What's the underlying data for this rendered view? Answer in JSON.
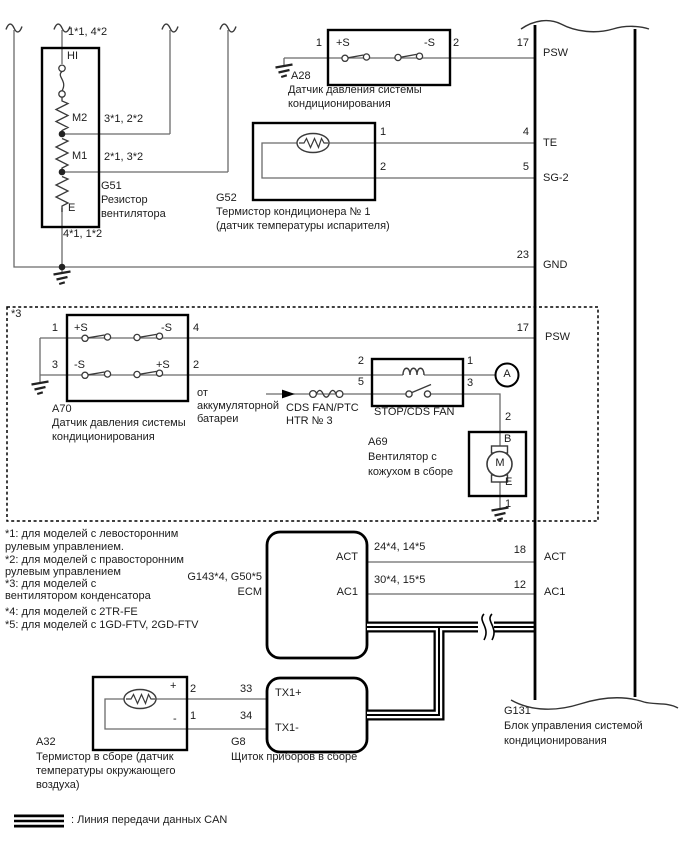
{
  "g51": {
    "w_top": "1*1, 4*2",
    "t_hi": "HI",
    "t_m2": "M2",
    "t_m1": "M1",
    "t_e": "E",
    "w_m2": "3*1, 2*2",
    "w_m1": "2*1, 3*2",
    "w_bot": "4*1, 1*2",
    "code": "G51",
    "name1": "Резистор",
    "name2": "вентилятора"
  },
  "a28": {
    "pin1": "1",
    "pin2": "2",
    "plus": "+S",
    "minus": "-S",
    "code": "A28",
    "name1": "Датчик давления системы",
    "name2": "кондиционирования"
  },
  "g52": {
    "pin1": "1",
    "pin2": "2",
    "code": "G52",
    "name1": "Термистор кондиционера № 1",
    "name2": "(датчик температуры испарителя)"
  },
  "region": {
    "note": "*3"
  },
  "a70": {
    "pin1": "1",
    "pin3": "3",
    "pin4": "4",
    "pin2": "2",
    "r1l": "+S",
    "r1r": "-S",
    "r2l": "-S",
    "r2r": "+S",
    "code": "A70",
    "name1": "Датчик давления системы",
    "name2": "кондиционирования"
  },
  "battery": {
    "l1": "от",
    "l2": "аккумуляторной",
    "l3": "батареи"
  },
  "fuse": {
    "l1": "CDS FAN/PTC",
    "l2": "HTR № 3"
  },
  "relay": {
    "pin2": "2",
    "pin5": "5",
    "pin1": "1",
    "pin3": "3",
    "name": "STOP/CDS FAN"
  },
  "conn_a": {
    "letter": "A"
  },
  "a69": {
    "pin2": "2",
    "t_b": "B",
    "motor": "M",
    "t_e": "E",
    "pin1": "1",
    "code": "A69",
    "name1": "Вентилятор с",
    "name2": "кожухом в сборе"
  },
  "notes": {
    "l1": "*1: для моделей с левосторонним",
    "l2": "рулевым управлением.",
    "l3": "*2: для моделей с правосторонним",
    "l4": "рулевым управлением",
    "l5": "*3: для моделей с",
    "l6": "вентилятором конденсатора",
    "l7": "*4: для моделей с 2TR-FE",
    "l8": "*5: для моделей с 1GD-FTV, 2GD-FTV"
  },
  "ecm": {
    "code": "G143*4, G50*5",
    "name": "ECM",
    "act": "ACT",
    "ac1": "AC1",
    "w_act": "24*4, 14*5",
    "w_ac1": "30*4, 15*5"
  },
  "a32": {
    "plus": "+",
    "minus": "-",
    "pin2": "2",
    "pin1": "1",
    "code": "A32",
    "name1": "Термистор в сборе (датчик",
    "name2": "температуры окружающего",
    "name3": "воздуха)"
  },
  "g8": {
    "p33": "33",
    "p34": "34",
    "tx1p": "TX1+",
    "tx1m": "TX1-",
    "code": "G8",
    "name": "Щиток приборов в сборе"
  },
  "bus": {
    "p17a": "17",
    "psw_a": "PSW",
    "p4": "4",
    "te": "TE",
    "p5": "5",
    "sg2": "SG-2",
    "p23": "23",
    "gnd": "GND",
    "p17b": "17",
    "psw_b": "PSW",
    "p18": "18",
    "act": "ACT",
    "p12": "12",
    "ac1": "AC1",
    "code": "G131",
    "name1": "Блок управления системой",
    "name2": "кондиционирования"
  },
  "legend": {
    "text": ": Линия передачи данных CAN"
  }
}
